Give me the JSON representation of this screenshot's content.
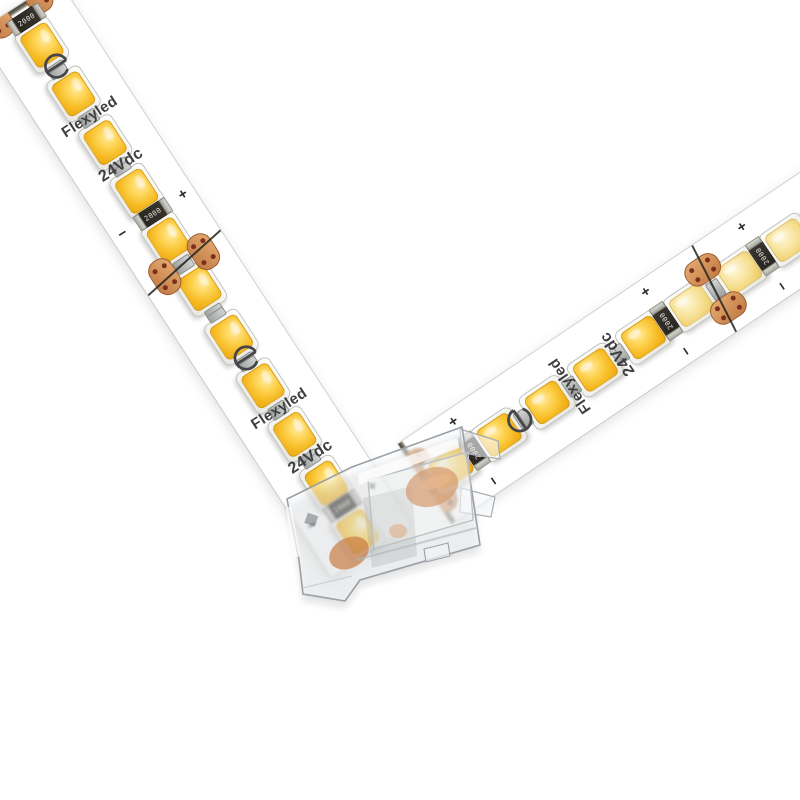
{
  "description": "Product photo: two white flexible LED strips joined at a right angle by a transparent L-shaped strip-to-strip corner connector on a white background",
  "product": {
    "brand": "Flexyled",
    "voltage": "24Vdc",
    "resistor_marking": "2000",
    "polarity_plus": "+",
    "polarity_minus": "−"
  },
  "colors": {
    "background": "#ffffff",
    "pcb_white": "#ffffff",
    "led_warm_core": "#f6ba22",
    "led_warm_light": "#ffeaa6",
    "led_pale_core": "#f2d87e",
    "package_white": "#fdfdfb",
    "silkscreen_text": "#3f3f41",
    "copper_pad": "#c07a42",
    "pad_hole": "#7c2f1d",
    "cut_line": "#23231f",
    "connector_plastic_stroke": "#9aa0a6",
    "connector_copper": "#c5763d",
    "resistor_body": "#2f2b26"
  },
  "strips": {
    "left": {
      "angle_deg": 57,
      "x": 58,
      "y": -20,
      "length": 650,
      "led_count": 11,
      "led_start": 45,
      "pitch": 58,
      "pale_from": 99,
      "cut_tilt": -9,
      "features": [
        "resistor",
        "logo",
        "brand",
        "voltage",
        "polarity",
        "cut",
        "blank",
        "logo",
        "brand",
        "voltage",
        "polarity"
      ]
    },
    "right": {
      "angle_deg": -34,
      "x": 398,
      "y": 444,
      "length": 540,
      "led_count": 9,
      "led_start": 30,
      "pitch": 58,
      "pale_from": 5,
      "cut_tilt": 7,
      "features": [
        "blank",
        "polarity",
        "logo",
        "brand",
        "voltage",
        "polarity",
        "cut",
        "polarity",
        "blank"
      ]
    }
  },
  "connector": {
    "type": "transparent L-shaped corner clip connector",
    "contacts": "copper"
  }
}
